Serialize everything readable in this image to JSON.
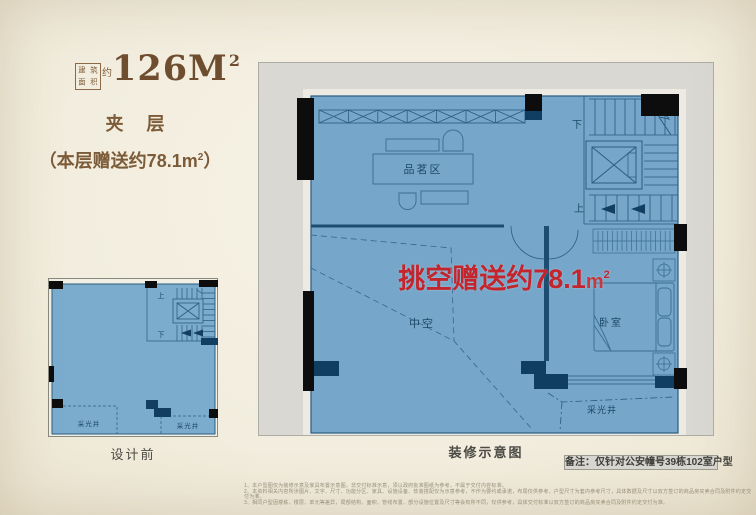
{
  "header": {
    "area_label_chars": [
      "建",
      "筑",
      "面",
      "积"
    ],
    "area_approx": "约",
    "area_value": "126M",
    "area_sup": "2",
    "floor_title": "夹 层",
    "bonus_note": {
      "pre": "（本层赠送约78.1",
      "unit": "m",
      "sup": "2",
      "post": "）"
    }
  },
  "before_plan": {
    "caption": "设计前",
    "up": "上",
    "down": "下",
    "light_well_left": "采光井",
    "light_well_right": "采光井"
  },
  "main_plan": {
    "caption": "装修示意图",
    "highlight": {
      "pre": "挑空赠送约78.1",
      "unit": "m",
      "sup": "2"
    },
    "rooms": {
      "tea_area": "品茗区",
      "void": "中空",
      "bedroom": "卧室",
      "light_well": "采光井"
    },
    "stairs": {
      "up": "上",
      "down": "下"
    }
  },
  "note": "备注：仅针对公安幢号39栋102室户型",
  "disclaimer": [
    "1、本户型图仅为装修示意及家具布置示意图，非交付标准示意，须以政府批准图纸为参考，不属于交付内容标准。",
    "2、本资料相关内容所涉图片、文字、尺寸、功能分区、家具、设施设备、软装搭配仅为示意参考，不作为要约或承诺，布局仅供参考，户型尺寸为套内参考尺寸，具体数据及尺寸以双方签订的商品房买卖合同及附件约定交付为准。",
    "3、相同户型因楼栋、楼层、单元等差异，局部结构、面积、管线布置、部分设施位置及尺寸等会有所不同，仅供参考，具体交付标准以双方签订的商品房买卖合同及附件约定交付为准。"
  ],
  "colors": {
    "accent_red": "#c4242c",
    "brown": "#7c5b38",
    "plan_blue": "#76a6c9",
    "wall_navy": "#103e63",
    "panel_gray": "#d9d8d3"
  }
}
